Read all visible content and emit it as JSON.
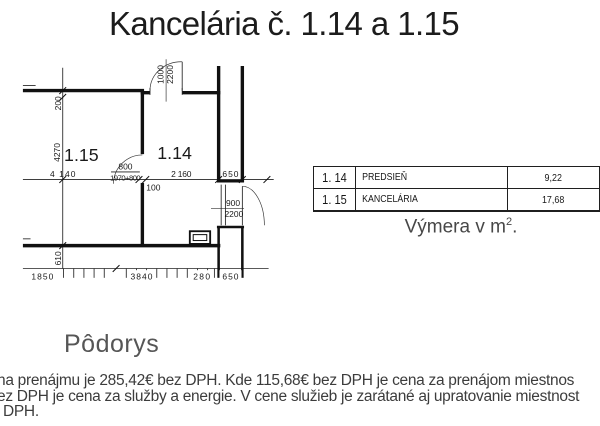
{
  "title": "Kancelária č. 1.14 a 1.15",
  "plan": {
    "caption": "Pôdorys",
    "room_labels": {
      "r115": "1.15",
      "r114": "1.14"
    },
    "dims": {
      "v200": "200",
      "v4270": "4270",
      "v610": "610",
      "h4140": "4 140",
      "d800": "800",
      "d1970": "1970+800",
      "h2160": "2 160",
      "h650": "650",
      "h100": "100",
      "door_top_w": "1000",
      "door_top_h": "2200",
      "door_right_w": "900",
      "door_right_h": "2200",
      "b1850": "1850",
      "b3840": "3840",
      "b280": "280",
      "b650": "650"
    }
  },
  "table": {
    "rows": [
      {
        "room": "1. 14",
        "name": "PREDSIEŇ",
        "area": "9,22"
      },
      {
        "room": "1. 15",
        "name": "KANCELÁRIA",
        "area": "17,68"
      }
    ]
  },
  "area_caption": {
    "prefix": "Výmera v m",
    "sup": "2",
    "suffix": "."
  },
  "paragraph": {
    "lines": [
      "na prenájmu je 285,42€ bez DPH. Kde 115,68€ bez DPH je cena za prenájom miestnos",
      "ez DPH je cena za služby a energie. V cene služieb je zarátané aj upratovanie miestnost",
      "DPH."
    ]
  }
}
